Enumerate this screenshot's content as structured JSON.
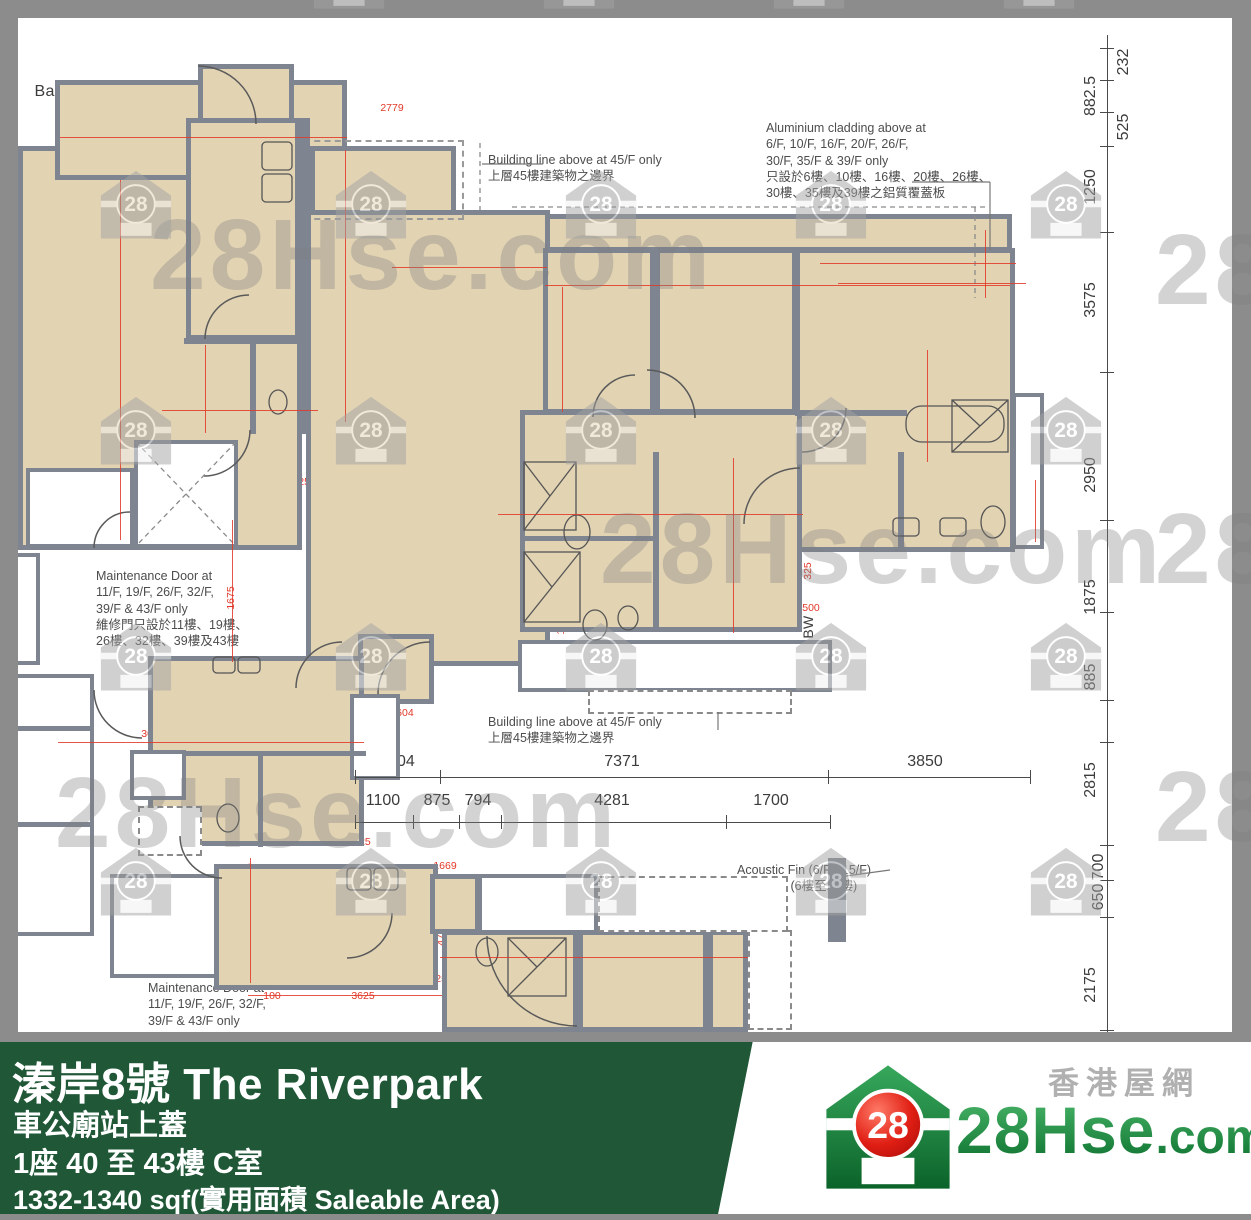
{
  "footer": {
    "title": "溱岸8號 The Riverpark",
    "subtitle": "車公廟站上蓋",
    "block_floor": "1座 40 至 43樓 C室",
    "area": "1332-1340 sqf(實用面積 Saleable Area)"
  },
  "logo": {
    "brand": "28Hse",
    "brand_suffix": ".com",
    "tagline": "香港屋網",
    "badge": "28"
  },
  "watermark": {
    "text": "28Hse.com",
    "icon": "28-house-watermark-icon",
    "badge": "28"
  },
  "plan": {
    "unit_b_label": "B",
    "unit_c_label": "C",
    "room_labels": [
      {
        "t": "Balcony",
        "x": 64,
        "y": 92,
        "fs": 16
      },
      {
        "t": "U.P.",
        "x": 262,
        "y": 101,
        "fs": 15
      },
      {
        "t": "Living",
        "x": 95,
        "y": 196,
        "fs": 17
      },
      {
        "t": "Kitchen",
        "x": 236,
        "y": 195,
        "fs": 17
      },
      {
        "t": "B",
        "x": 93,
        "y": 297,
        "fs": 30
      },
      {
        "t": "Dining",
        "x": 97,
        "y": 388,
        "fs": 17
      },
      {
        "t": "Store",
        "x": 222,
        "y": 394,
        "fs": 15
      },
      {
        "t": "WC",
        "x": 277,
        "y": 394,
        "fs": 15
      },
      {
        "t": "Tel. Room",
        "x": 81,
        "y": 497,
        "fs": 12
      },
      {
        "t": "Pipe Well",
        "x": 186,
        "y": 513,
        "fs": 12
      },
      {
        "t": "Balcony",
        "x": 374,
        "y": 178,
        "fs": 15
      },
      {
        "t": "BW",
        "x": 582,
        "y": 229,
        "fs": 15
      },
      {
        "t": "BW",
        "x": 694,
        "y": 229,
        "fs": 15
      },
      {
        "t": "BW",
        "x": 858,
        "y": 229,
        "fs": 15
      },
      {
        "t": "Living",
        "x": 411,
        "y": 332,
        "fs": 19
      },
      {
        "t": "C",
        "x": 409,
        "y": 440,
        "fs": 33
      },
      {
        "t": "Dining",
        "x": 411,
        "y": 552,
        "fs": 18
      },
      {
        "t": "Bedroom 3",
        "x": 580,
        "y": 333,
        "fs": 17
      },
      {
        "t": "Bedroom 2",
        "x": 703,
        "y": 332,
        "fs": 17
      },
      {
        "t": "Master\nBedroom",
        "x": 869,
        "y": 342,
        "fs": 17
      },
      {
        "t": "Walk-in\nCloset",
        "x": 836,
        "y": 492,
        "fs": 15
      },
      {
        "t": "Bathroom",
        "x": 959,
        "y": 490,
        "fs": 14
      },
      {
        "t": "Bathroom",
        "x": 588,
        "y": 497,
        "fs": 14
      },
      {
        "t": "Bedroom 1",
        "x": 718,
        "y": 551,
        "fs": 16
      },
      {
        "t": "Bathroom",
        "x": 586,
        "y": 608,
        "fs": 14
      },
      {
        "t": "BW",
        "x": 808,
        "y": 627,
        "fs": 14,
        "v": 1
      },
      {
        "t": "U.P.",
        "x": 407,
        "y": 672,
        "fs": 15
      },
      {
        "t": "A/C Platform",
        "x": 636,
        "y": 671,
        "fs": 11.5
      },
      {
        "t": "A/C\nPlatform",
        "x": 374,
        "y": 737,
        "fs": 10,
        "v": 1
      },
      {
        "t": "A/C Platform",
        "x": 1027,
        "y": 471,
        "fs": 9.5,
        "v": 1
      },
      {
        "t": "Kitchen",
        "x": 276,
        "y": 710,
        "fs": 17
      },
      {
        "t": "P.D.",
        "x": 158,
        "y": 775,
        "fs": 10.5
      },
      {
        "t": "WC",
        "x": 226,
        "y": 798,
        "fs": 15
      },
      {
        "t": "Store",
        "x": 311,
        "y": 798,
        "fs": 15
      },
      {
        "t": "E&D",
        "x": 170,
        "y": 833,
        "fs": 10.5
      },
      {
        "t": "M.C.",
        "x": 28,
        "y": 705,
        "fs": 10.5
      },
      {
        "t": "Refuse Room",
        "x": 173,
        "y": 928,
        "fs": 12
      },
      {
        "t": "Kitchen",
        "x": 307,
        "y": 922,
        "fs": 17
      },
      {
        "t": "U.P.",
        "x": 455,
        "y": 903,
        "fs": 14
      },
      {
        "t": "A/C\nPlatform",
        "x": 539,
        "y": 896,
        "fs": 10.5
      },
      {
        "t": "Bathroom",
        "x": 519,
        "y": 984,
        "fs": 14
      },
      {
        "t": "Bedroom 2",
        "x": 628,
        "y": 984,
        "fs": 15
      },
      {
        "t": "BW",
        "x": 710,
        "y": 991,
        "fs": 13,
        "v": 1
      }
    ],
    "notes": [
      {
        "x": 488,
        "y": 152,
        "lines": "Building line above at 45/F only\n上層45樓建築物之邊界"
      },
      {
        "x": 766,
        "y": 120,
        "lines": "Aluminium cladding above at\n6/F, 10/F, 16/F, 20/F, 26/F,\n30/F, 35/F & 39/F only\n只設於6樓、10樓、16樓、20樓、26樓、\n30樓、35樓及39樓之鋁質覆蓋板"
      },
      {
        "x": 96,
        "y": 568,
        "lines": "Maintenance Door at\n11/F, 19/F, 26/F, 32/F,\n39/F & 43/F only\n維修門只設於11樓、19樓、\n26樓、32樓、39樓及43樓"
      },
      {
        "x": 488,
        "y": 714,
        "lines": "Building line above at 45/F only\n上層45樓建築物之邊界"
      },
      {
        "x": 737,
        "y": 862,
        "lines": "Acoustic Fin (6/F - 15/F)\n隔音翼牆 (6樓至15樓)"
      },
      {
        "x": 148,
        "y": 980,
        "lines": "Maintenance Door at\n11/F, 19/F, 26/F, 32/F,\n39/F & 43/F only"
      }
    ],
    "dims_red": [
      {
        "t": "2300",
        "x": 215,
        "y": 12
      },
      {
        "t": "1700",
        "x": 748,
        "y": 12
      },
      {
        "t": "2779",
        "x": 392,
        "y": 108
      },
      {
        "t": "125",
        "x": 222,
        "y": 110,
        "v": 1
      },
      {
        "t": "3350",
        "x": 72,
        "y": 137
      },
      {
        "t": "100",
        "x": 199,
        "y": 137
      },
      {
        "t": "1950",
        "x": 240,
        "y": 137
      },
      {
        "t": "1250",
        "x": 344,
        "y": 196,
        "v": 1
      },
      {
        "t": "125",
        "x": 338,
        "y": 232,
        "v": 1
      },
      {
        "t": "4000",
        "x": 413,
        "y": 266
      },
      {
        "t": "75",
        "x": 514,
        "y": 266
      },
      {
        "t": "500",
        "x": 549,
        "y": 230,
        "v": 1
      },
      {
        "t": "300",
        "x": 549,
        "y": 262,
        "v": 1
      },
      {
        "t": "1750",
        "x": 592,
        "y": 263
      },
      {
        "t": "2300",
        "x": 570,
        "y": 284
      },
      {
        "t": "75",
        "x": 648,
        "y": 284
      },
      {
        "t": "1750",
        "x": 697,
        "y": 263
      },
      {
        "t": "2300",
        "x": 702,
        "y": 284
      },
      {
        "t": "75",
        "x": 754,
        "y": 284
      },
      {
        "t": "3525",
        "x": 862,
        "y": 263
      },
      {
        "t": "300",
        "x": 946,
        "y": 265
      },
      {
        "t": "3650",
        "x": 844,
        "y": 283
      },
      {
        "t": "950",
        "x": 987,
        "y": 264,
        "v": 1
      },
      {
        "t": "6450",
        "x": 122,
        "y": 315,
        "v": 1
      },
      {
        "t": "3000",
        "x": 562,
        "y": 353,
        "v": 1
      },
      {
        "t": "250",
        "x": 947,
        "y": 327,
        "v": 1
      },
      {
        "t": "2960",
        "x": 928,
        "y": 372,
        "v": 1
      },
      {
        "t": "250",
        "x": 941,
        "y": 430,
        "v": 1
      },
      {
        "t": "75",
        "x": 693,
        "y": 430
      },
      {
        "t": "1150",
        "x": 748,
        "y": 430
      },
      {
        "t": "5525",
        "x": 799,
        "y": 417,
        "v": 1
      },
      {
        "t": "900",
        "x": 562,
        "y": 437,
        "v": 1
      },
      {
        "t": "1850",
        "x": 204,
        "y": 367,
        "v": 1
      },
      {
        "t": "75",
        "x": 204,
        "y": 349,
        "v": 1
      },
      {
        "t": "100",
        "x": 172,
        "y": 410
      },
      {
        "t": "1250",
        "x": 222,
        "y": 411
      },
      {
        "t": "75",
        "x": 248,
        "y": 411
      },
      {
        "t": "775",
        "x": 277,
        "y": 411
      },
      {
        "t": "100",
        "x": 311,
        "y": 411
      },
      {
        "t": "250",
        "x": 280,
        "y": 268
      },
      {
        "t": "200",
        "x": 167,
        "y": 450
      },
      {
        "t": "100",
        "x": 203,
        "y": 450
      },
      {
        "t": "100",
        "x": 92,
        "y": 482
      },
      {
        "t": "100",
        "x": 117,
        "y": 480,
        "v": 1
      },
      {
        "t": "250",
        "x": 307,
        "y": 482
      },
      {
        "t": "7975",
        "x": 338,
        "y": 452,
        "v": 1
      },
      {
        "t": "305",
        "x": 232,
        "y": 523,
        "v": 1
      },
      {
        "t": "1450",
        "x": 52,
        "y": 481
      },
      {
        "t": "5250",
        "x": 378,
        "y": 568
      },
      {
        "t": "1675",
        "x": 231,
        "y": 598,
        "v": 1
      },
      {
        "t": "250",
        "x": 506,
        "y": 516
      },
      {
        "t": "2300",
        "x": 589,
        "y": 515
      },
      {
        "t": "75",
        "x": 641,
        "y": 515
      },
      {
        "t": "2473",
        "x": 718,
        "y": 515
      },
      {
        "t": "200",
        "x": 768,
        "y": 515
      },
      {
        "t": "550",
        "x": 800,
        "y": 513
      },
      {
        "t": "75",
        "x": 831,
        "y": 513
      },
      {
        "t": "2500",
        "x": 927,
        "y": 459,
        "v": 1
      },
      {
        "t": "2700",
        "x": 951,
        "y": 505
      },
      {
        "t": "200",
        "x": 927,
        "y": 528,
        "v": 1
      },
      {
        "t": "125",
        "x": 1035,
        "y": 512,
        "v": 1
      },
      {
        "t": "325",
        "x": 808,
        "y": 571,
        "v": 1
      },
      {
        "t": "300",
        "x": 788,
        "y": 608
      },
      {
        "t": "500",
        "x": 811,
        "y": 608
      },
      {
        "t": "165",
        "x": 552,
        "y": 512,
        "v": 1
      },
      {
        "t": "75",
        "x": 560,
        "y": 565,
        "v": 1
      },
      {
        "t": "1650",
        "x": 561,
        "y": 623,
        "v": 1
      },
      {
        "t": "125",
        "x": 561,
        "y": 663,
        "v": 1
      },
      {
        "t": "250",
        "x": 697,
        "y": 668
      },
      {
        "t": "300",
        "x": 752,
        "y": 668,
        "v": 1
      },
      {
        "t": "3250",
        "x": 734,
        "y": 590,
        "v": 1
      },
      {
        "t": "1450",
        "x": 752,
        "y": 613,
        "v": 1
      },
      {
        "t": "250",
        "x": 343,
        "y": 625,
        "v": 1
      },
      {
        "t": "1604",
        "x": 402,
        "y": 713
      },
      {
        "t": "125",
        "x": 337,
        "y": 714
      },
      {
        "t": "300",
        "x": 150,
        "y": 734
      },
      {
        "t": "3900",
        "x": 228,
        "y": 743
      },
      {
        "t": "2250",
        "x": 232,
        "y": 718,
        "v": 1
      },
      {
        "t": "125",
        "x": 334,
        "y": 717
      },
      {
        "t": "100",
        "x": 175,
        "y": 784,
        "v": 1
      },
      {
        "t": "825",
        "x": 214,
        "y": 826
      },
      {
        "t": "75",
        "x": 257,
        "y": 839
      },
      {
        "t": "1800",
        "x": 304,
        "y": 826
      },
      {
        "t": "100",
        "x": 190,
        "y": 842
      },
      {
        "t": "125",
        "x": 362,
        "y": 842
      },
      {
        "t": "1669",
        "x": 445,
        "y": 866
      },
      {
        "t": "250",
        "x": 250,
        "y": 872,
        "v": 1
      },
      {
        "t": "100",
        "x": 228,
        "y": 888
      },
      {
        "t": "3500",
        "x": 325,
        "y": 888
      },
      {
        "t": "1800",
        "x": 231,
        "y": 912,
        "v": 1
      },
      {
        "t": "125",
        "x": 390,
        "y": 903
      },
      {
        "t": "1125",
        "x": 416,
        "y": 933,
        "v": 1
      },
      {
        "t": "475",
        "x": 441,
        "y": 937,
        "v": 1
      },
      {
        "t": "325",
        "x": 421,
        "y": 972,
        "v": 1
      },
      {
        "t": "250",
        "x": 444,
        "y": 979
      },
      {
        "t": "100",
        "x": 313,
        "y": 942,
        "v": 1
      },
      {
        "t": "100",
        "x": 272,
        "y": 996
      },
      {
        "t": "3625",
        "x": 363,
        "y": 996
      },
      {
        "t": "1750",
        "x": 490,
        "y": 957
      },
      {
        "t": "75",
        "x": 552,
        "y": 957
      },
      {
        "t": "2200",
        "x": 617,
        "y": 957
      },
      {
        "t": "300",
        "x": 688,
        "y": 958
      },
      {
        "t": "500",
        "x": 711,
        "y": 958
      },
      {
        "t": "2200",
        "x": 591,
        "y": 1000,
        "v": 1
      },
      {
        "t": "775",
        "x": 650,
        "y": 1002,
        "v": 1
      },
      {
        "t": "200",
        "x": 590,
        "y": 900,
        "v": 1
      }
    ],
    "dims_black": [
      {
        "t": "1604",
        "x": 397,
        "y": 762
      },
      {
        "t": "7371",
        "x": 622,
        "y": 762
      },
      {
        "t": "3850",
        "x": 925,
        "y": 762
      },
      {
        "t": "1100",
        "x": 383,
        "y": 801
      },
      {
        "t": "875",
        "x": 437,
        "y": 801
      },
      {
        "t": "794",
        "x": 478,
        "y": 801
      },
      {
        "t": "4281",
        "x": 612,
        "y": 801
      },
      {
        "t": "1700",
        "x": 771,
        "y": 801
      },
      {
        "t": "232",
        "x": 1124,
        "y": 62,
        "v": 1
      },
      {
        "t": "882.5",
        "x": 1091,
        "y": 96,
        "v": 1
      },
      {
        "t": "525",
        "x": 1124,
        "y": 127,
        "v": 1
      },
      {
        "t": "1250",
        "x": 1091,
        "y": 187,
        "v": 1
      },
      {
        "t": "3575",
        "x": 1091,
        "y": 300,
        "v": 1
      },
      {
        "t": "2950",
        "x": 1091,
        "y": 475,
        "v": 1
      },
      {
        "t": "1875",
        "x": 1091,
        "y": 597,
        "v": 1
      },
      {
        "t": "885",
        "x": 1091,
        "y": 677,
        "v": 1
      },
      {
        "t": "2815",
        "x": 1091,
        "y": 780,
        "v": 1
      },
      {
        "t": "700",
        "x": 1099,
        "y": 867,
        "v": 1
      },
      {
        "t": "650",
        "x": 1099,
        "y": 897,
        "v": 1
      },
      {
        "t": "2175",
        "x": 1091,
        "y": 985,
        "v": 1
      }
    ]
  }
}
